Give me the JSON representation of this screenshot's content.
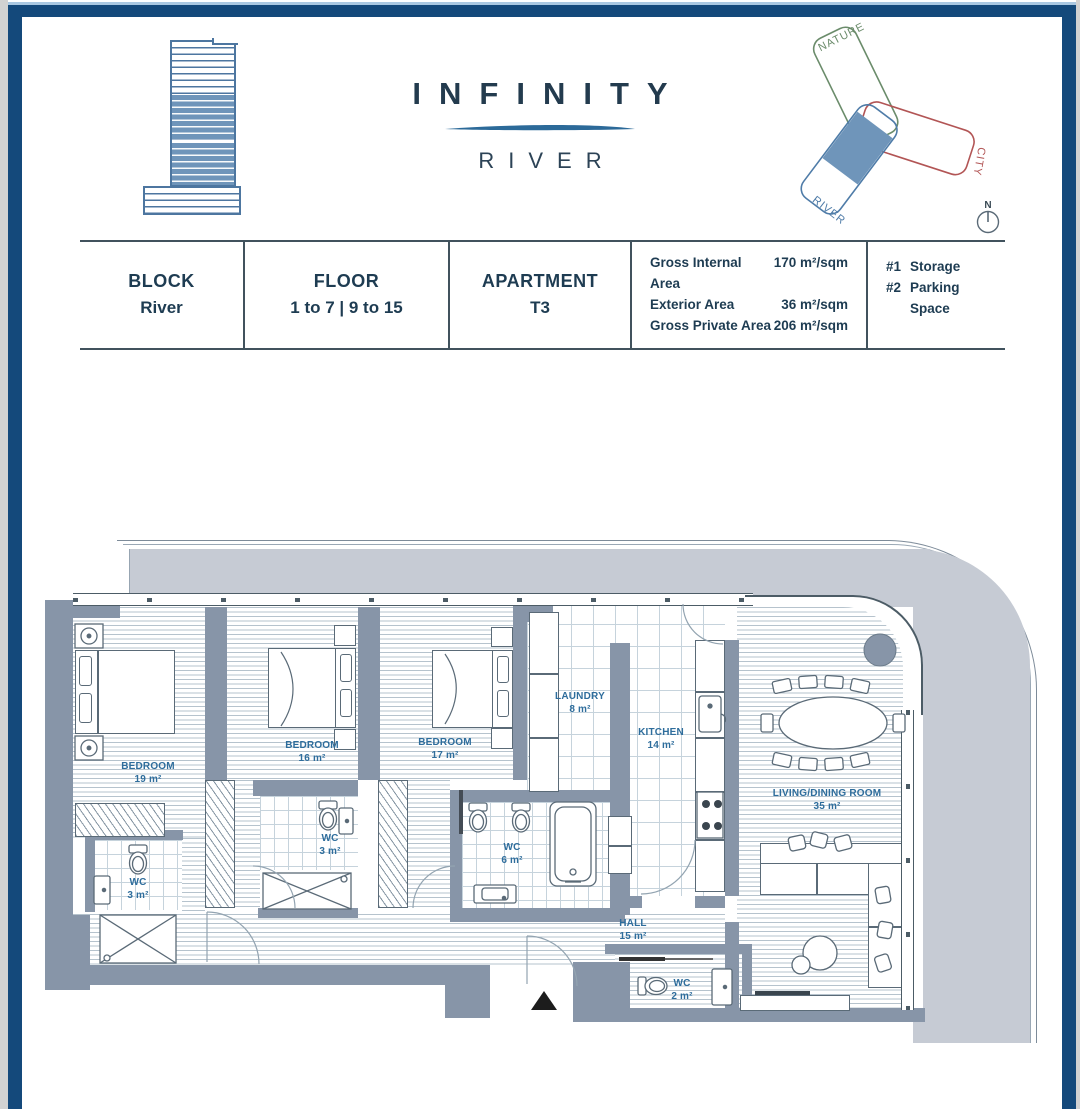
{
  "brand": {
    "title": "INFINITY",
    "subtitle": "RIVER"
  },
  "site_diagram": {
    "nature_label": "NATURE",
    "city_label": "CITY",
    "river_label": "RIVER",
    "compass_label": "N"
  },
  "info_table": {
    "cells": [
      {
        "header": "BLOCK",
        "value": "River"
      },
      {
        "header": "FLOOR",
        "value": "1 to 7 | 9 to 15"
      },
      {
        "header": "APARTMENT",
        "value": "T3"
      }
    ],
    "areas": [
      {
        "label": "Gross Internal Area",
        "value": "170 m²/sqm"
      },
      {
        "label": "Exterior Area",
        "value": "36 m²/sqm"
      },
      {
        "label": "Gross Private Area",
        "value": "206 m²/sqm"
      }
    ],
    "extras": [
      {
        "num": "#1",
        "label": "Storage"
      },
      {
        "num": "#2",
        "label": "Parking Space"
      }
    ]
  },
  "floorplan": {
    "rooms": [
      {
        "name": "BEDROOM",
        "area": "19 m²"
      },
      {
        "name": "BEDROOM",
        "area": "16 m²"
      },
      {
        "name": "BEDROOM",
        "area": "17 m²"
      },
      {
        "name": "LAUNDRY",
        "area": "8 m²"
      },
      {
        "name": "KITCHEN",
        "area": "14 m²"
      },
      {
        "name": "LIVING/DINING ROOM",
        "area": "35 m²"
      },
      {
        "name": "WC",
        "area": "3 m²"
      },
      {
        "name": "WC",
        "area": "3 m²"
      },
      {
        "name": "WC",
        "area": "6 m²"
      },
      {
        "name": "WC",
        "area": "2 m²"
      },
      {
        "name": "HALL",
        "area": "15 m²"
      }
    ]
  },
  "colors": {
    "frame_navy": "#14497b",
    "accent_light_blue": "#aac8e2",
    "wall_gray": "#8795a8",
    "balcony_gray": "#c6cbd4",
    "label_blue": "#2e6d9c",
    "title_navy": "#233b4e",
    "wing_green": "#6b8c6b",
    "wing_red": "#b25555",
    "wing_blue": "#4f7ca8",
    "wing_fill": "#6f95ba"
  }
}
